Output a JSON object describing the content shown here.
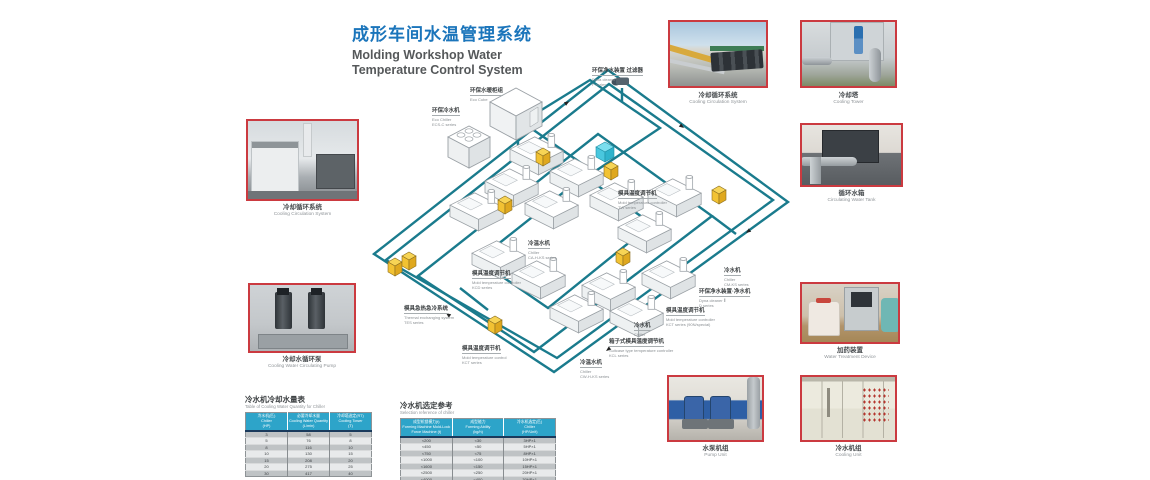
{
  "title": {
    "zh": "成形车间水温管理系统",
    "en1": "Molding Workshop Water",
    "en2": "Temperature Control System"
  },
  "photos": {
    "p1": {
      "zh": "冷却循环系统",
      "en": "Cooling Circulation System"
    },
    "p2": {
      "zh": "冷却水循环泵",
      "en": "Cooling Water Circulating Pump"
    },
    "p3": {
      "zh": "冷却循环系统",
      "en": "Cooling Circulation System"
    },
    "p4": {
      "zh": "冷却塔",
      "en": "Cooling Tower"
    },
    "p5": {
      "zh": "循环水箱",
      "en": "Circulating Water Tank"
    },
    "p6": {
      "zh": "加药装置",
      "en": "Water Treatment Device"
    },
    "p7": {
      "zh": "水泵机组",
      "en": "Pump Unit"
    },
    "p8": {
      "zh": "冷水机组",
      "en": "Cooling Unit"
    }
  },
  "diagram": {
    "labels": [
      {
        "zh": "环保水暖柜组",
        "en": "Eco Cube",
        "series": ""
      },
      {
        "zh": "环保冷水机",
        "en": "Eco Chiller",
        "series": "ECS-C series"
      },
      {
        "zh": "环保净水装置 过滤器",
        "en": "Dyna cleaner",
        "series": "F series"
      },
      {
        "zh": "模具温度调节机",
        "en": "Mold temperature controller",
        "series": "TW series"
      },
      {
        "zh": "冷温水机",
        "en": "Chiller",
        "series": "CA-H-KS series"
      },
      {
        "zh": "模具温度调节机",
        "en": "Mold temperature controller",
        "series": "KCD series"
      },
      {
        "zh": "模具急热急冷系统",
        "en": "Thermal exchanging system",
        "series": "TES series"
      },
      {
        "zh": "模具温度调节机",
        "en": "Mold temperature control",
        "series": "KCT series"
      },
      {
        "zh": "冷水机",
        "en": "Chiller",
        "series": "CM-KS series"
      },
      {
        "zh": "环保净水装置·净水机",
        "en": "Dyna cleaner Ⅱ",
        "series": "D series"
      },
      {
        "zh": "模具温度调节机",
        "en": "Mold temperature controller",
        "series": "KCT series (90N/special)"
      },
      {
        "zh": "冷水机",
        "en": "Chiller",
        "series": "CW-KS series"
      },
      {
        "zh": "箱子式模具温度调节机",
        "en": "Suitcase type temperature controller",
        "series": "KCL series"
      },
      {
        "zh": "冷温水机",
        "en": "Chiller",
        "series": "CW-H-KS series"
      }
    ]
  },
  "table1": {
    "title_zh": "冷水机冷却水量表",
    "title_en": "Table of Cooling Water Quantity for Chiller",
    "headers": [
      [
        "冷水机(匹)",
        "Chiller",
        "(HP)"
      ],
      [
        "必要冷却水量",
        "Cooling Water Quantity",
        "(L/min)"
      ],
      [
        "冷却塔选定(RT)",
        "Cooling Tower",
        "(T)"
      ]
    ],
    "rows": [
      [
        "3",
        "58",
        "5"
      ],
      [
        "5",
        "76",
        "8"
      ],
      [
        "8",
        "116",
        "10"
      ],
      [
        "10",
        "130",
        "15"
      ],
      [
        "15",
        "208",
        "20"
      ],
      [
        "20",
        "275",
        "25"
      ],
      [
        "30",
        "417",
        "40"
      ]
    ]
  },
  "table2": {
    "title_zh": "冷水机选定参考",
    "title_en": "Selection reference of chiller",
    "headers": [
      [
        "成型机锁模力(t)",
        "Forming Machine Mold-Lock",
        "Force Machine (t)"
      ],
      [
        "成型能力",
        "Forming Ability",
        "(kg/h)"
      ],
      [
        "冷水机选定(匹)",
        "Chiller",
        "(HP/Unit)"
      ]
    ],
    "rows": [
      [
        "<200",
        "<30",
        "3HP×1"
      ],
      [
        "<450",
        "<50",
        "5HP×1"
      ],
      [
        "<750",
        "<75",
        "8HP×1"
      ],
      [
        "<1000",
        "<100",
        "10HP×1"
      ],
      [
        "<1600",
        "<150",
        "15HP×1"
      ],
      [
        "<2500",
        "<250",
        "20HP×1"
      ],
      [
        "<4000",
        "<400",
        "30HP×1"
      ]
    ]
  },
  "colors": {
    "accent_blue": "#1b75bb",
    "photo_border": "#cb3a40",
    "pipe_teal": "#1a7b8d",
    "table_header": "#2da4c9",
    "unit_yellow": "#f2c233"
  }
}
